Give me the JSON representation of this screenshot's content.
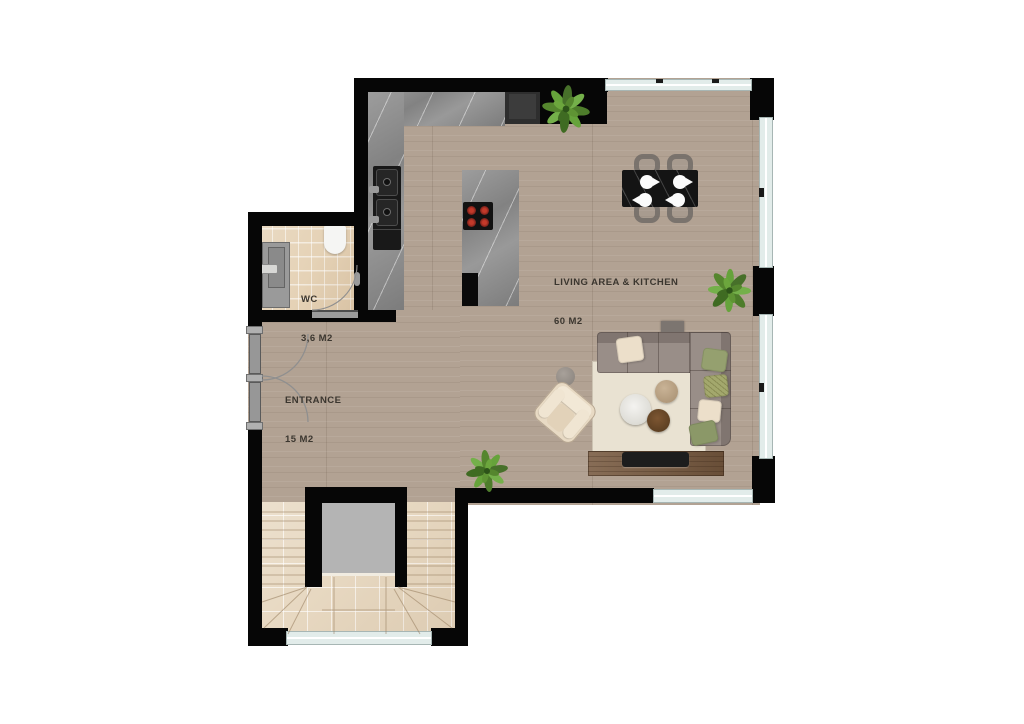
{
  "plan": {
    "type": "apartment-floor-plan",
    "rooms": {
      "living": {
        "label": "LIVING AREA & KITCHEN",
        "area": "60 M2"
      },
      "entrance": {
        "label": "ENTRANCE",
        "area": "15 M2"
      },
      "wc": {
        "label": "WC",
        "area": "3,6 M2"
      }
    },
    "colors": {
      "wall": "#060606",
      "wood_floor": "#b2a293",
      "tile_floor": "#e7d8c1",
      "counter_marble": "#8f8f8f",
      "window": "#e2ecea",
      "sofa": "#998e88",
      "rug": "#e9e2d2",
      "plant_green": "#5b8f33",
      "burner_red": "#a02020",
      "dining_table": "#141414"
    },
    "elements": {
      "plants": 3,
      "dining_chairs": 4,
      "entrance_doors": 2
    }
  }
}
